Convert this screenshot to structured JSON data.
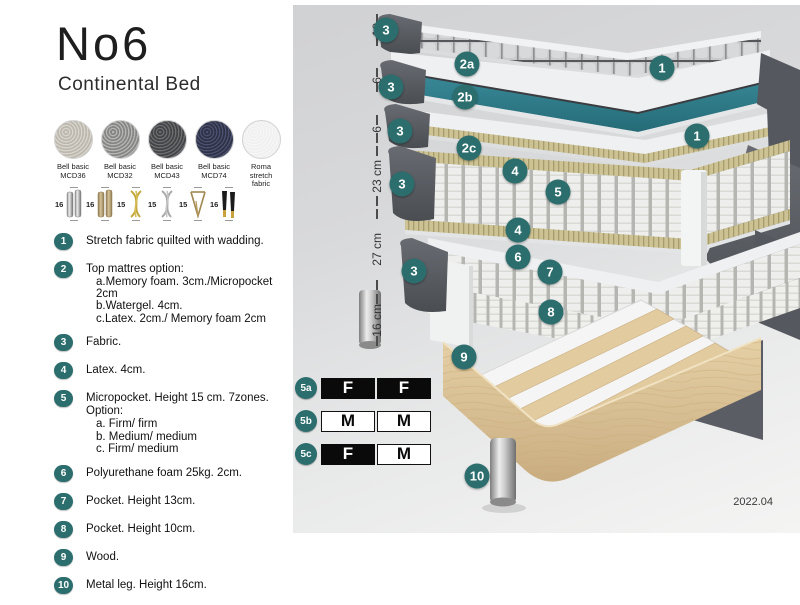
{
  "product": {
    "title": "No6",
    "subtitle": "Continental Bed"
  },
  "swatches": [
    {
      "name": "Bell basic",
      "code": "MCD36",
      "color": "#c9c5bc"
    },
    {
      "name": "Bell basic",
      "code": "MCD32",
      "color": "#9b9b99"
    },
    {
      "name": "Bell basic",
      "code": "MCD43",
      "color": "#55575a"
    },
    {
      "name": "Bell basic",
      "code": "MCD74",
      "color": "#3c4059"
    },
    {
      "name": "Roma",
      "code": "stretch fabric",
      "color": "#f3f3f3"
    }
  ],
  "legs": [
    {
      "height": "16",
      "type": "cylinder-silver"
    },
    {
      "height": "16",
      "type": "cylinder-brass"
    },
    {
      "height": "15",
      "type": "twisted-gold"
    },
    {
      "height": "15",
      "type": "twisted-silver"
    },
    {
      "height": "15",
      "type": "hairpin"
    },
    {
      "height": "16",
      "type": "tapered-black-gold"
    }
  ],
  "legend": [
    {
      "num": "1",
      "text": "Stretch fabric quilted with wadding."
    },
    {
      "num": "2",
      "text": "Top mattres option:",
      "sub": [
        "a.Memory foam. 3cm./Micropocket 2cm",
        "b.Watergel. 4cm.",
        "c.Latex. 2cm./ Memory foam 2cm"
      ]
    },
    {
      "num": "3",
      "text": "Fabric."
    },
    {
      "num": "4",
      "text": "Latex. 4cm."
    },
    {
      "num": "5",
      "text": "Micropocket. Height 15 cm. 7zones. Option:",
      "sub": [
        "a. Firm/ firm",
        "b. Medium/ medium",
        "c. Firm/ medium"
      ]
    },
    {
      "num": "6",
      "text": "Polyurethane foam 25kg. 2cm."
    },
    {
      "num": "7",
      "text": "Pocket. Height 13cm."
    },
    {
      "num": "8",
      "text": "Pocket. Height 10cm."
    },
    {
      "num": "9",
      "text": "Wood."
    },
    {
      "num": "10",
      "text": "Metal leg. Height 16cm."
    }
  ],
  "diagram": {
    "dimensions": [
      {
        "label": "10"
      },
      {
        "label": "6"
      },
      {
        "label": "6"
      },
      {
        "label": "23 cm"
      },
      {
        "label": "27 cm"
      },
      {
        "label": "16 cm"
      }
    ],
    "badges": [
      {
        "label": "3"
      },
      {
        "label": "2a"
      },
      {
        "label": "1"
      },
      {
        "label": "3"
      },
      {
        "label": "2b"
      },
      {
        "label": "1"
      },
      {
        "label": "3"
      },
      {
        "label": "2c"
      },
      {
        "label": "4"
      },
      {
        "label": "3"
      },
      {
        "label": "5"
      },
      {
        "label": "4"
      },
      {
        "label": "6"
      },
      {
        "label": "3"
      },
      {
        "label": "7"
      },
      {
        "label": "8"
      },
      {
        "label": "9"
      },
      {
        "label": "10"
      }
    ],
    "firmness_table": {
      "rows": [
        {
          "key": "5a",
          "cells": [
            {
              "text": "F",
              "style": "dark"
            },
            {
              "text": "F",
              "style": "dark"
            }
          ]
        },
        {
          "key": "5b",
          "cells": [
            {
              "text": "M",
              "style": "light"
            },
            {
              "text": "M",
              "style": "light"
            }
          ]
        },
        {
          "key": "5c",
          "cells": [
            {
              "text": "F",
              "style": "dark"
            },
            {
              "text": "M",
              "style": "light"
            }
          ]
        }
      ]
    },
    "version": "2022.04"
  },
  "colors": {
    "accent": "#2c6e6d",
    "watergel": "#2f7f8b",
    "latex": "#ccc293",
    "wood": "#dcc69c"
  }
}
